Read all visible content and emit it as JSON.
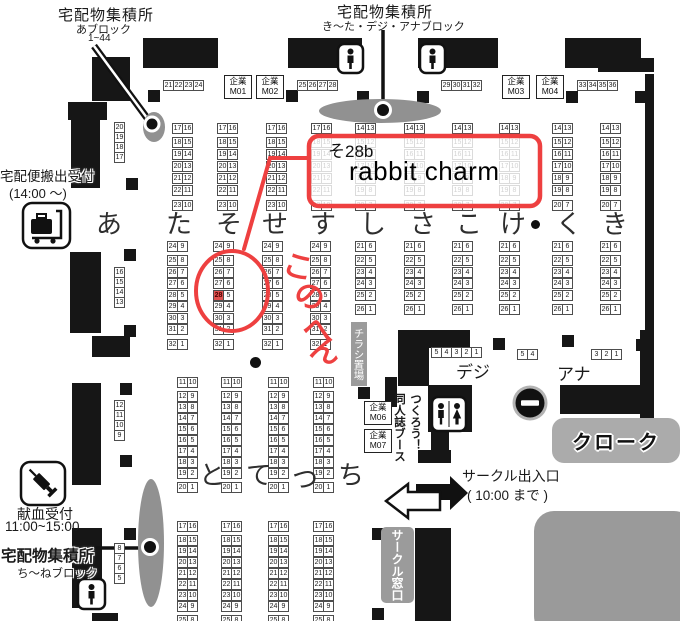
{
  "colors": {
    "red": "#ee4040",
    "wall": "#161616",
    "gray": "#919191",
    "highlight": "#e0514e"
  },
  "labels": {
    "top_left": {
      "title": "宅配物集積所",
      "block": "あブロック",
      "range": "1~44"
    },
    "top_center": {
      "title": "宅配物集積所",
      "block": "き〜た・デジ・アナブロック"
    },
    "carryout": {
      "l1": "宅配便搬出受付",
      "l2": "(14:00 〜)"
    },
    "blood": {
      "l1": "献血受付",
      "l2": "11:00~15:00"
    },
    "bottom_left": {
      "title": "宅配物集積所",
      "block": "ち〜ねブロック"
    },
    "deji": "デジ",
    "ana": "アナ",
    "cloak": "クローク",
    "entrance_l1": "サークル出入口",
    "entrance_l2": "( 10:00 まで )",
    "window": "サークル窓口",
    "flyer": "チラシ置場",
    "doujin_r": "つくろう！",
    "doujin_l": "同人誌ブース"
  },
  "annotations": {
    "code": "そ28b",
    "name": "rabbit charm",
    "highlighted_booth": "28",
    "chars": [
      {
        "ch": "こ",
        "x": 284,
        "y": 242,
        "r": 15
      },
      {
        "ch": "の",
        "x": 296,
        "y": 272,
        "r": 28
      },
      {
        "ch": "へ",
        "x": 303,
        "y": 305,
        "r": 8
      },
      {
        "ch": "ん",
        "x": 312,
        "y": 326,
        "r": 22
      }
    ]
  },
  "rows_top": [
    {
      "t": "あ",
      "x": 96,
      "y": 204
    },
    {
      "t": "た",
      "x": 166,
      "y": 204
    },
    {
      "t": "そ",
      "x": 216,
      "y": 204
    },
    {
      "t": "せ",
      "x": 262,
      "y": 204
    },
    {
      "t": "す",
      "x": 310,
      "y": 204
    },
    {
      "t": "し",
      "x": 360,
      "y": 204
    },
    {
      "t": "さ",
      "x": 410,
      "y": 204
    },
    {
      "t": "こ",
      "x": 456,
      "y": 204
    },
    {
      "t": "け",
      "x": 500,
      "y": 204
    },
    {
      "t": "く",
      "x": 556,
      "y": 204
    },
    {
      "t": "き",
      "x": 602,
      "y": 204
    }
  ],
  "rows_bottom": [
    {
      "t": "と",
      "x": 199,
      "y": 455
    },
    {
      "t": "て",
      "x": 246,
      "y": 455
    },
    {
      "t": "つ",
      "x": 292,
      "y": 459
    },
    {
      "t": "ち",
      "x": 338,
      "y": 455
    }
  ],
  "companies": [
    {
      "x": 224,
      "y": 75,
      "l1": "企業",
      "l2": "M01"
    },
    {
      "x": 256,
      "y": 75,
      "l1": "企業",
      "l2": "M02"
    },
    {
      "x": 502,
      "y": 75,
      "l1": "企業",
      "l2": "M03"
    },
    {
      "x": 536,
      "y": 75,
      "l1": "企業",
      "l2": "M04"
    },
    {
      "x": 364,
      "y": 401,
      "l1": "企業",
      "l2": "M06"
    },
    {
      "x": 364,
      "y": 429,
      "l1": "企業",
      "l2": "M07"
    }
  ],
  "strips": [
    {
      "x": 163,
      "y": 80,
      "nums": [
        "21",
        "22",
        "23",
        "24"
      ]
    },
    {
      "x": 297,
      "y": 80,
      "nums": [
        "25",
        "26",
        "27",
        "28"
      ]
    },
    {
      "x": 441,
      "y": 80,
      "nums": [
        "29",
        "30",
        "31",
        "32"
      ]
    },
    {
      "x": 577,
      "y": 80,
      "nums": [
        "33",
        "34",
        "35",
        "36"
      ]
    },
    {
      "x": 431,
      "y": 347,
      "nums": [
        "5",
        "4",
        "3",
        "2",
        "1"
      ]
    },
    {
      "x": 517,
      "y": 349,
      "nums": [
        "5",
        "4"
      ]
    },
    {
      "x": 591,
      "y": 349,
      "nums": [
        "3",
        "2",
        "1"
      ]
    }
  ],
  "singles": [
    {
      "x": 114,
      "y": 122,
      "nums": [
        "20",
        "19",
        "18",
        "17"
      ]
    },
    {
      "x": 114,
      "y": 267,
      "nums": [
        "16",
        "15",
        "14",
        "13"
      ]
    },
    {
      "x": 114,
      "y": 400,
      "nums": [
        "12",
        "11",
        "10",
        "9"
      ]
    },
    {
      "x": 114,
      "y": 543,
      "nums": [
        "8",
        "7",
        "6",
        "5"
      ]
    }
  ],
  "groups": [
    {
      "xs": [
        172,
        217,
        266,
        311
      ],
      "y": 123,
      "pitch": 12,
      "header": [
        "17",
        "16"
      ],
      "rows": [
        [
          "18",
          "15"
        ],
        [
          "19",
          "14"
        ],
        [
          "20",
          "13"
        ],
        [
          "21",
          "12"
        ],
        [
          "22",
          "11"
        ]
      ],
      "footer": [
        "23",
        "10"
      ]
    },
    {
      "xs": [
        355,
        404,
        452,
        499,
        552,
        600
      ],
      "y": 123,
      "pitch": 12,
      "header": [
        "14",
        "13"
      ],
      "rows": [
        [
          "15",
          "12"
        ],
        [
          "16",
          "11"
        ],
        [
          "17",
          "10"
        ],
        [
          "18",
          "9"
        ],
        [
          "19",
          "8"
        ]
      ],
      "footer": [
        "20",
        "7"
      ]
    },
    {
      "xs": [
        167,
        213,
        262,
        310
      ],
      "y": 241,
      "pitch": 11.5,
      "header": [
        "24",
        "9"
      ],
      "rows": [
        [
          "25",
          "8"
        ],
        [
          "26",
          "7"
        ],
        [
          "27",
          "6"
        ],
        [
          "28",
          "5"
        ],
        [
          "29",
          "4"
        ],
        [
          "30",
          "3"
        ],
        [
          "31",
          "2"
        ]
      ],
      "footer": [
        "32",
        "1"
      ],
      "hl": {
        "col": 1,
        "row": 3,
        "cell": 0
      }
    },
    {
      "xs": [
        355,
        404,
        452,
        499,
        552,
        600
      ],
      "y": 241,
      "pitch": 11.5,
      "header": [
        "21",
        "6"
      ],
      "rows": [
        [
          "22",
          "5"
        ],
        [
          "23",
          "4"
        ],
        [
          "24",
          "3"
        ],
        [
          "25",
          "2"
        ]
      ],
      "footer": [
        "26",
        "1"
      ]
    },
    {
      "xs": [
        177,
        221,
        268,
        313
      ],
      "y": 377,
      "pitch": 11,
      "header": [
        "11",
        "10"
      ],
      "rows": [
        [
          "12",
          "9"
        ],
        [
          "13",
          "8"
        ],
        [
          "14",
          "7"
        ],
        [
          "15",
          "6"
        ],
        [
          "16",
          "5"
        ],
        [
          "17",
          "4"
        ],
        [
          "18",
          "3"
        ],
        [
          "19",
          "2"
        ]
      ],
      "footer": [
        "20",
        "1"
      ]
    },
    {
      "xs": [
        177,
        221,
        268,
        313
      ],
      "y": 521,
      "pitch": 11,
      "header": [
        "17",
        "16"
      ],
      "rows": [
        [
          "18",
          "15"
        ],
        [
          "19",
          "14"
        ],
        [
          "20",
          "13"
        ],
        [
          "21",
          "12"
        ],
        [
          "22",
          "11"
        ],
        [
          "23",
          "10"
        ],
        [
          "24",
          "9"
        ]
      ],
      "footer": [
        "25",
        "8"
      ]
    }
  ],
  "map": {
    "walls": [
      [
        143,
        38,
        75,
        30
      ],
      [
        288,
        38,
        74,
        30
      ],
      [
        418,
        38,
        80,
        30
      ],
      [
        565,
        38,
        76,
        30
      ],
      [
        598,
        58,
        56,
        14
      ],
      [
        92,
        57,
        38,
        44
      ],
      [
        68,
        102,
        39,
        18
      ],
      [
        71,
        119,
        29,
        69
      ],
      [
        70,
        252,
        31,
        81
      ],
      [
        92,
        336,
        38,
        21
      ],
      [
        72,
        383,
        29,
        102
      ],
      [
        72,
        528,
        30,
        80
      ],
      [
        92,
        613,
        26,
        8
      ],
      [
        645,
        74,
        9,
        282
      ],
      [
        640,
        330,
        14,
        93
      ],
      [
        560,
        385,
        94,
        29
      ],
      [
        398,
        330,
        72,
        18
      ],
      [
        398,
        348,
        31,
        38
      ],
      [
        428,
        385,
        44,
        47
      ],
      [
        385,
        377,
        12,
        30
      ],
      [
        431,
        432,
        18,
        19
      ],
      [
        418,
        450,
        33,
        13
      ],
      [
        415,
        528,
        36,
        93
      ]
    ],
    "pillars": [
      [
        148,
        90
      ],
      [
        286,
        90
      ],
      [
        357,
        91
      ],
      [
        417,
        91
      ],
      [
        566,
        91
      ],
      [
        635,
        91
      ],
      [
        126,
        178
      ],
      [
        124,
        249
      ],
      [
        124,
        325
      ],
      [
        120,
        383
      ],
      [
        120,
        455
      ],
      [
        124,
        528
      ],
      [
        358,
        387
      ],
      [
        493,
        338
      ],
      [
        562,
        335
      ],
      [
        636,
        339
      ],
      [
        372,
        528
      ],
      [
        372,
        608
      ]
    ],
    "bullets": [
      [
        250,
        357,
        11
      ],
      [
        531,
        220,
        9
      ]
    ]
  }
}
